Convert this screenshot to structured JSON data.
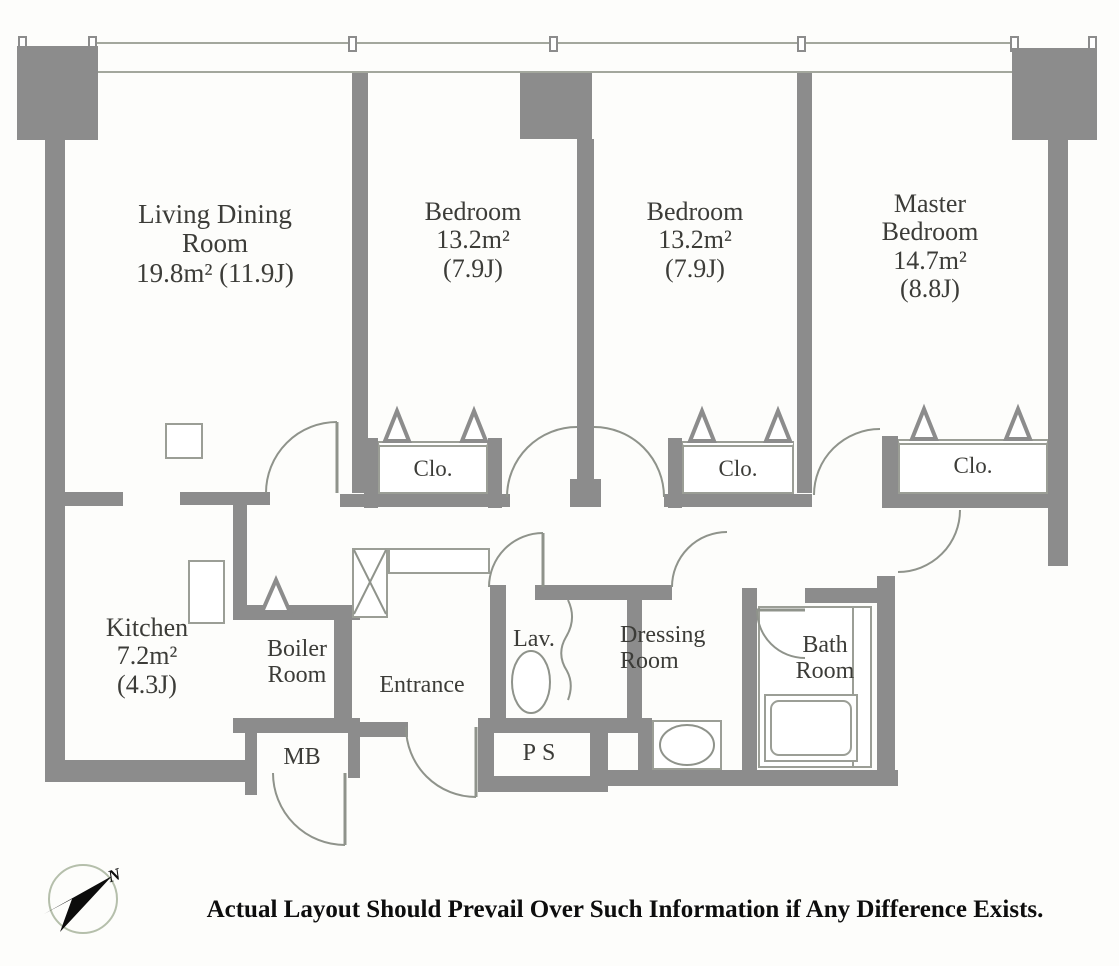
{
  "plan": {
    "rooms": {
      "living": {
        "line1": "Living Dining",
        "line2": "Room",
        "line3": "19.8m² (11.9J)"
      },
      "bedroom1": {
        "line1": "Bedroom",
        "line2": "13.2m²",
        "line3": "(7.9J)"
      },
      "bedroom2": {
        "line1": "Bedroom",
        "line2": "13.2m²",
        "line3": "(7.9J)"
      },
      "master": {
        "line1": "Master",
        "line2": "Bedroom",
        "line3": "14.7m²",
        "line4": "(8.8J)"
      },
      "kitchen": {
        "line1": "Kitchen",
        "line2": "7.2m²",
        "line3": "(4.3J)"
      },
      "boiler": {
        "line1": "Boiler",
        "line2": "Room"
      },
      "entrance": {
        "line1": "Entrance"
      },
      "lavatory": {
        "line1": "Lav."
      },
      "dressing": {
        "line1": "Dressing",
        "line2": "Room"
      },
      "bath": {
        "line1": "Bath",
        "line2": "Room"
      },
      "meter_box": {
        "line1": "MB"
      },
      "pipe_space": {
        "line1": "PS"
      },
      "closet1": {
        "line1": "Clo."
      },
      "closet2": {
        "line1": "Clo."
      },
      "closet3": {
        "line1": "Clo."
      }
    },
    "compass_label": "N",
    "disclaimer": "Actual Layout Should Prevail Over Such Information if Any Difference Exists.",
    "colors": {
      "wall": "#8c8c8c",
      "thin_line": "#9b9e96",
      "text": "#3c3c38",
      "background": "#fdfdfb",
      "compass_ring": "#b5bfab"
    }
  }
}
